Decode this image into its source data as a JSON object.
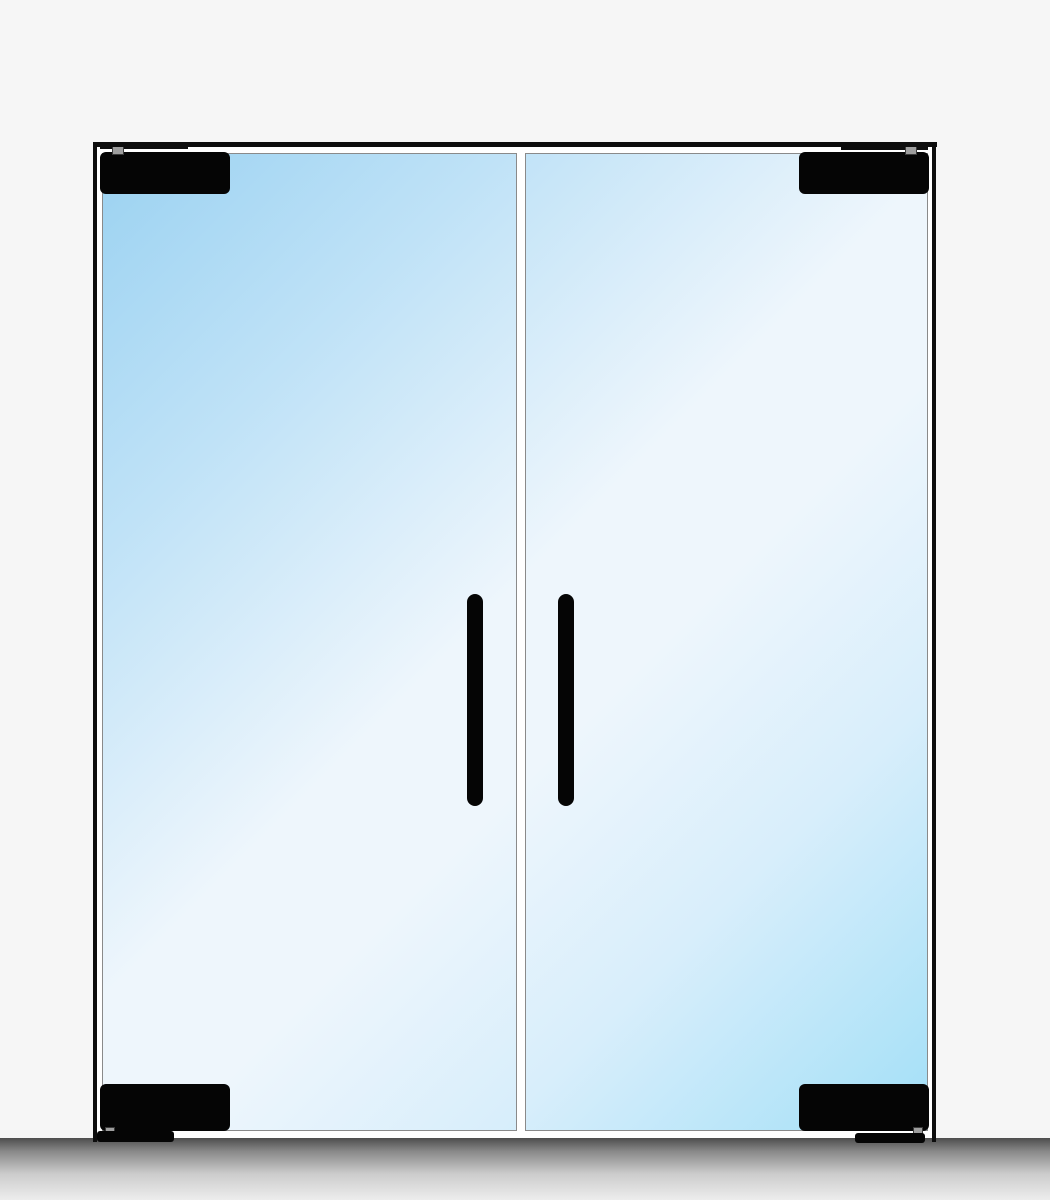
{
  "scene": {
    "type": "product-illustration",
    "subject": "frameless glass double swing door, elevation view",
    "door_count": 2,
    "visible_text": ""
  },
  "components": {
    "frame": "door frame (header and side jambs)",
    "left_door": "left glass door panel",
    "right_door": "right glass door panel",
    "center_gap": "gap between door panels",
    "left_handle": "left door vertical pull handle",
    "right_handle": "right door vertical pull handle",
    "fitting_top_left": "top-left patch fitting",
    "fitting_top_right": "top-right patch fitting",
    "fitting_bottom_left": "bottom-left patch fitting",
    "fitting_bottom_right": "bottom-right patch fitting",
    "pivot_pins": "top and bottom pivot pins",
    "floor_plates": "bottom pivot floor plates",
    "floor": "floor shadow band"
  },
  "colors": {
    "page_bg": "#f6f6f6",
    "interior_bg": "#ffffff",
    "frame": "#0d0d0d",
    "hardware": "#050505",
    "panel_border": "#8a8a8a",
    "pivot_pin_fill": "#9e9e9e",
    "pivot_pin_border": "#3a3a3a",
    "glass_stop_1": "#9bd2f1",
    "glass_stop_2": "#bfe2f7",
    "glass_stop_3": "#eef6fc",
    "glass_stop_4": "#d8eefb",
    "glass_stop_5": "#a2dff7",
    "floor_top": "#4d4d4d",
    "floor_mid_1": "#8a8a8a",
    "floor_mid_2": "#cccccc",
    "floor_bottom": "#ededed"
  }
}
